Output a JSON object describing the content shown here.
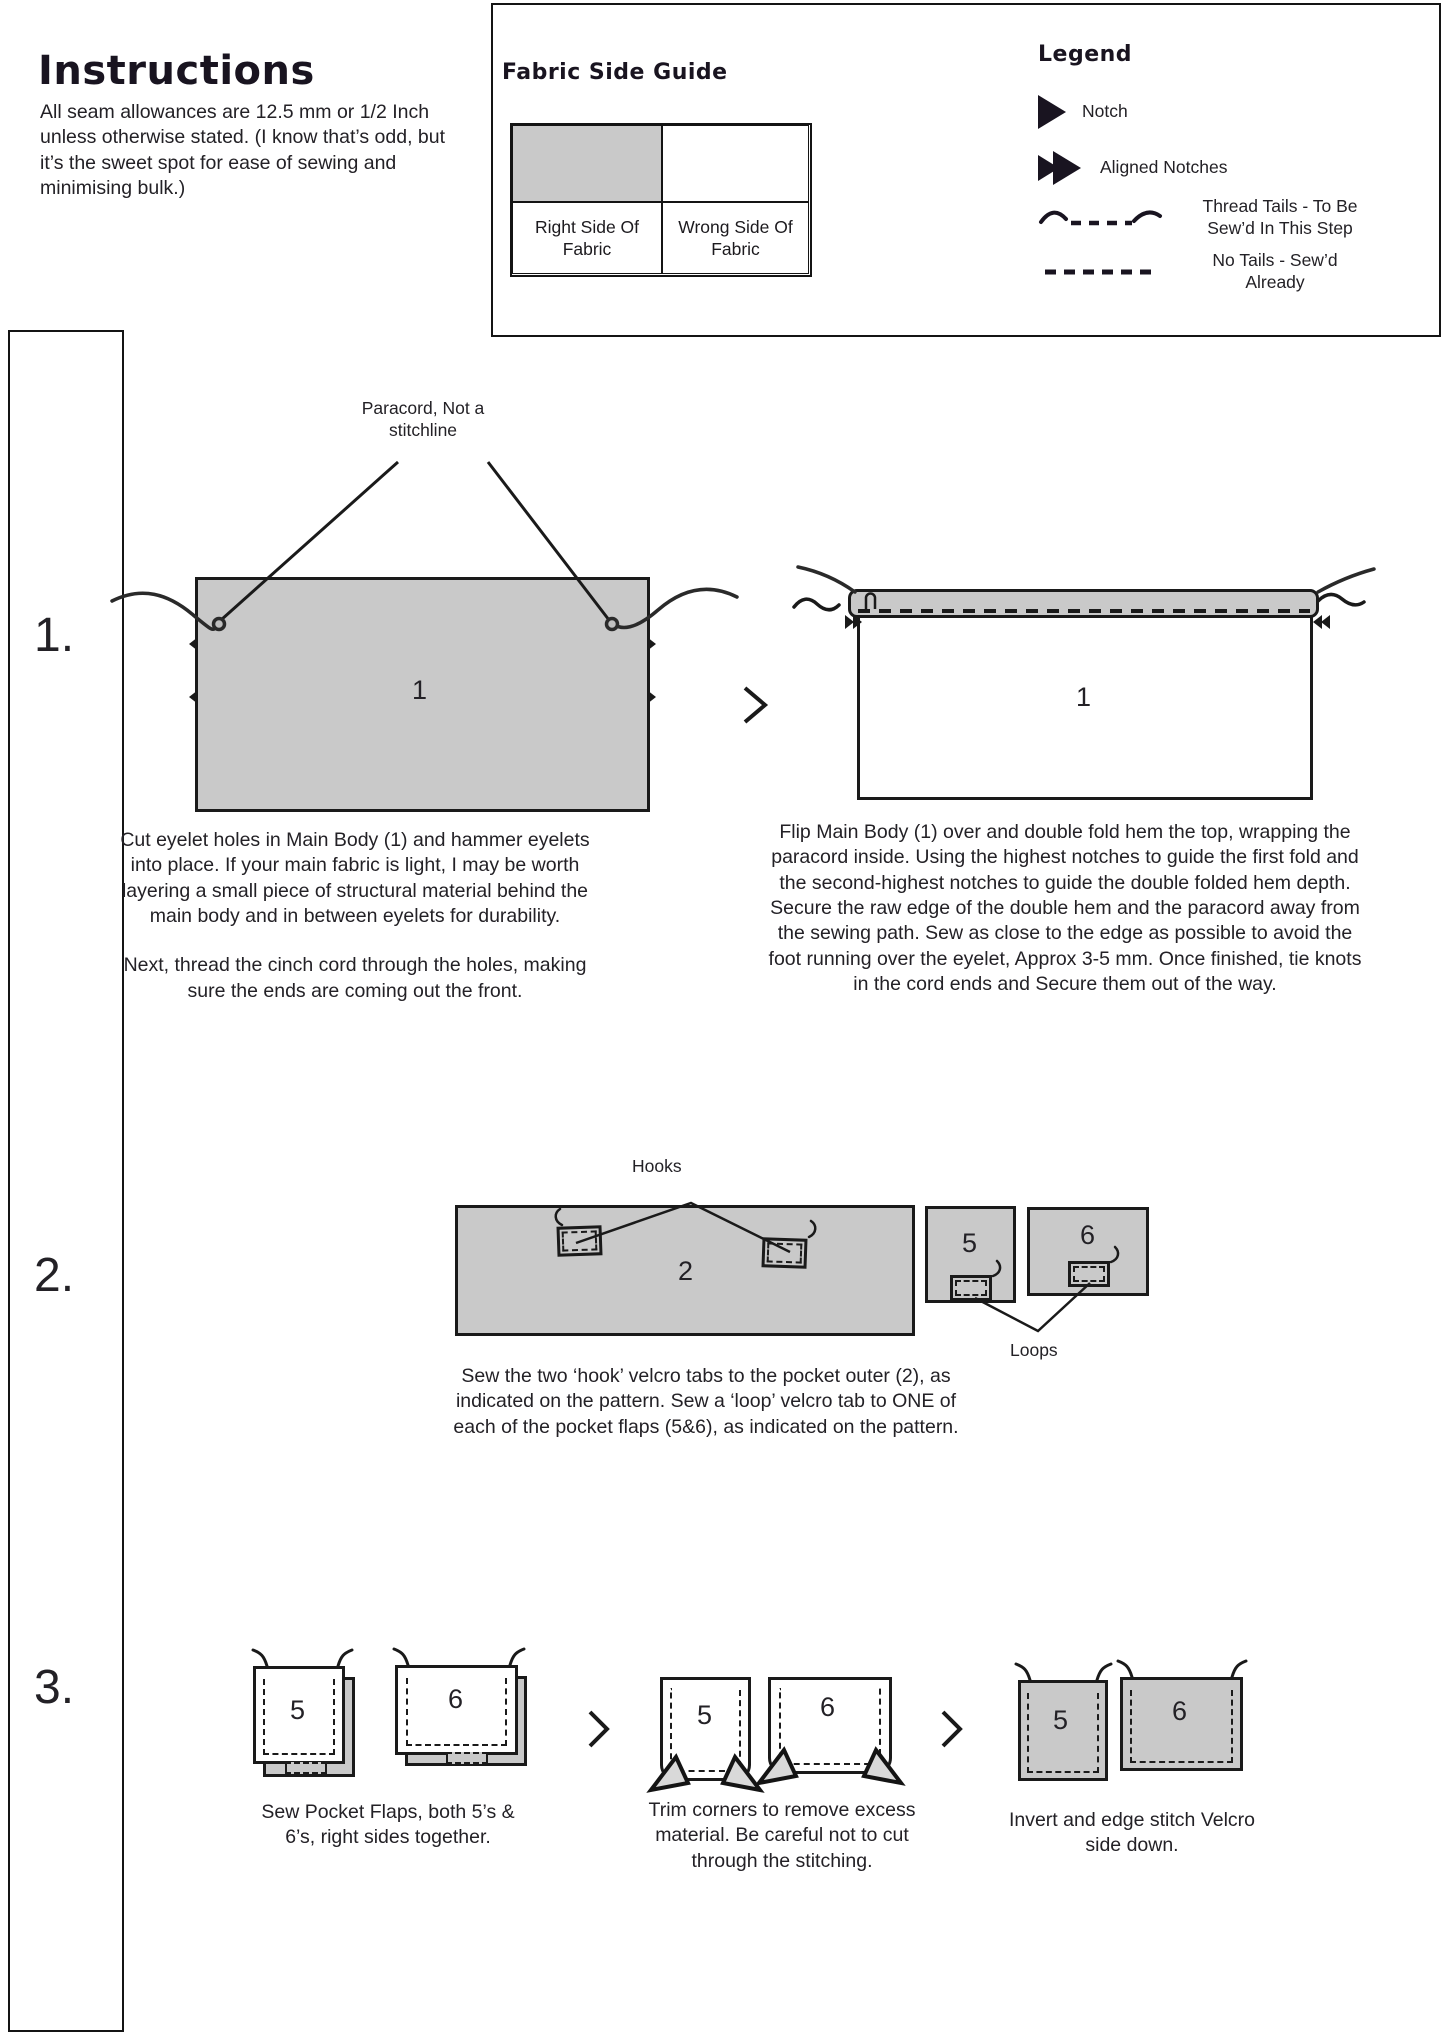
{
  "header": {
    "title": "Instructions",
    "intro": "All seam allowances are 12.5 mm or 1/2 Inch unless otherwise stated. (I know that’s odd, but it’s the sweet spot for ease of sewing and minimising bulk.)"
  },
  "fabric_guide": {
    "title": "Fabric Side Guide",
    "right_label": "Right Side Of Fabric",
    "wrong_label": "Wrong Side Of Fabric"
  },
  "legend": {
    "title": "Legend",
    "items": [
      {
        "icon": "notch-icon",
        "label": "Notch"
      },
      {
        "icon": "aligned-notches-icon",
        "label": "Aligned Notches"
      },
      {
        "icon": "thread-tails-icon",
        "label": "Thread Tails - To Be Sew’d In This Step"
      },
      {
        "icon": "no-tails-icon",
        "label": "No Tails - Sew’d Already"
      }
    ]
  },
  "steps": {
    "one": {
      "number": "1.",
      "annotation": "Paracord, Not a stitchline",
      "piece_label": "1",
      "text_left_a": "Cut eyelet holes in Main Body (1) and hammer eyelets into place. If your main fabric is light, I may be worth layering a small piece of structural material behind the main body and in between eyelets for durability.",
      "text_left_b": "Next, thread the cinch cord through the holes, making sure the ends are coming out the front.",
      "text_right": "Flip Main Body (1) over and double fold hem the top, wrapping the paracord inside. Using the highest notches to guide the first fold and the second-highest notches to guide the double folded hem depth. Secure the raw edge of the double hem and the paracord away from the sewing path. Sew as close to the edge as possible to avoid the foot running over the eyelet, Approx 3-5 mm. Once finished, tie knots in the cord ends and Secure them out of the way."
    },
    "two": {
      "number": "2.",
      "hooks_label": "Hooks",
      "loops_label": "Loops",
      "piece2_label": "2",
      "piece5_label": "5",
      "piece6_label": "6",
      "text": "Sew the two ‘hook’ velcro tabs to the pocket outer (2), as indicated on the pattern. Sew a ‘loop’ velcro tab to ONE of each of the pocket flaps (5&6), as indicated on the pattern."
    },
    "three": {
      "number": "3.",
      "piece5_label": "5",
      "piece6_label": "6",
      "text_a": "Sew Pocket Flaps, both 5’s & 6’s, right sides together.",
      "text_b": "Trim corners to remove excess material. Be careful not to cut through the stitching.",
      "text_c": "Invert and edge stitch Velcro side down."
    }
  },
  "colors": {
    "fabric_gray": "#c9c9c9",
    "ink": "#1a1a1a"
  }
}
